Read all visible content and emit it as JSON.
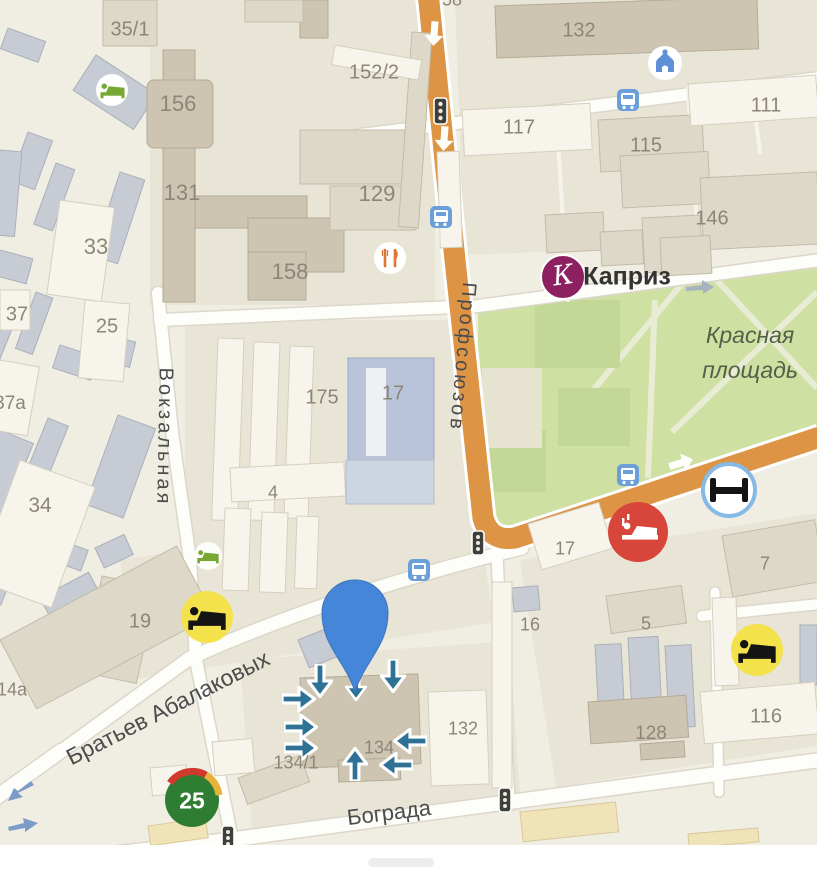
{
  "streets": {
    "vokzalnaya": "Вокзальная",
    "profsoyuzov": "Профсоюзов",
    "abalakovykh": "Братьев Абалаковых",
    "bograda": "Бограда"
  },
  "places": {
    "park": "Красная площадь",
    "business": "Каприз",
    "business_initial": "К",
    "store_badge": "25"
  },
  "building_numbers": [
    "35/1",
    "156",
    "131",
    "33",
    "25",
    "37",
    "37а",
    "34",
    "152/2",
    "129",
    "158",
    "132",
    "117",
    "115",
    "111",
    "146",
    "175",
    "17",
    "4",
    "19",
    "14а",
    "16",
    "17",
    "5",
    "7",
    "116",
    "128",
    "132",
    "134",
    "134/1",
    "58"
  ],
  "icons": {
    "map_pin": "map-pin-icon",
    "hotel_green": "hotel-bed-green-icon",
    "hotel_yellow": "hotel-bed-yellow-icon",
    "hotel_red": "hotel-bed-red-icon",
    "hotel_ring": "hotel-bed-ring-icon",
    "restaurant": "restaurant-icon",
    "home_landmark": "home-landmark-icon",
    "bus_stop": "bus-stop-icon",
    "traffic_light": "traffic-light-icon",
    "store_25": "store-25-icon",
    "direction_arrow": "direction-arrow-icon",
    "oneway_arrow": "oneway-arrow-icon"
  },
  "colors": {
    "map_bg": "#f0ede3",
    "block": "#e9e5d6",
    "building_tan": "#ded8c8",
    "building_dark_tan": "#cdc5b2",
    "building_gray": "#c6cbd4",
    "building_blue": "#b9c4da",
    "park_green": "#cfe0a3",
    "road_orange": "#dd9445",
    "road_white": "#fdfdf9",
    "pin_blue": "#4686d8",
    "arrow_teal": "#2d7195",
    "hotel_yellow": "#f4e24d",
    "hotel_red": "#d8453a",
    "kapriz_purple": "#8c2060",
    "store_green": "#2f7d33",
    "label_gray": "#8d8677"
  }
}
